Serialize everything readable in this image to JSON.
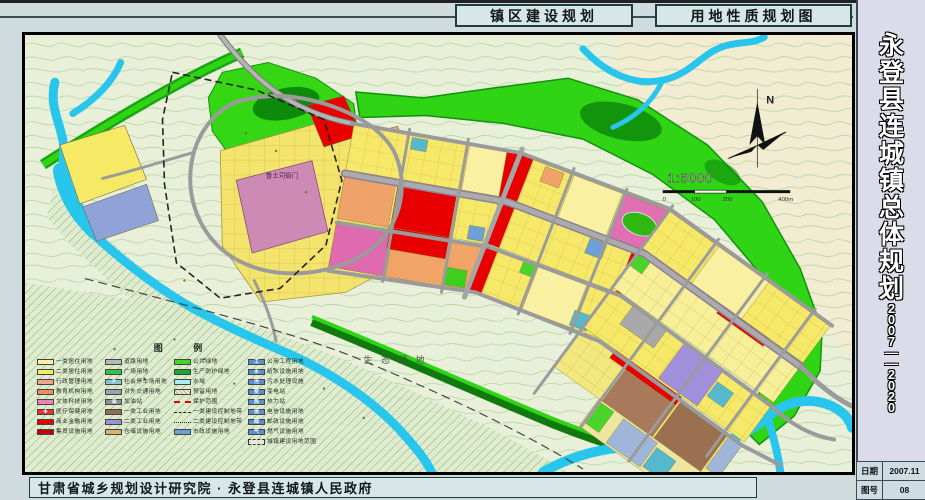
{
  "header": {
    "title_left": "镇区建设规划",
    "title_right": "用地性质规划图"
  },
  "sidebar": {
    "title": "永登县连城镇总体规划",
    "years": "2007——2020",
    "date_label": "日期",
    "date_value": "2007.11",
    "sheet_label": "图号",
    "sheet_value": "08"
  },
  "footer": {
    "credit": "甘肃省城乡规划设计研究院 · 永登县连城镇人民政府"
  },
  "map": {
    "north_label": "N",
    "scale": {
      "text": "1:5000",
      "ticks": [
        "0",
        "100",
        "200",
        "400m"
      ]
    },
    "labels": {
      "eco": "生 态 绿 地",
      "yamen": "鲁土司衙门"
    },
    "colors": {
      "residential1": "#f9f0a2",
      "residential2": "#f5e965",
      "commercial": "#e80000",
      "industry2": "#a090dc",
      "storage": "#a8795a",
      "green_public": "#2fd414",
      "water": "#28c6ec",
      "road": "#9b9b9b",
      "utility_blue": "#5b8fd0"
    },
    "legend": {
      "title": "图 例",
      "columns": [
        {
          "items": [
            {
              "label": "一类居住用地",
              "color": "#f9f0a2",
              "type": "fill"
            },
            {
              "label": "二类居住用地",
              "color": "#f5e965",
              "type": "fill"
            },
            {
              "label": "行政管理用地",
              "color": "#f2a687",
              "type": "fill"
            },
            {
              "label": "教育机构用地",
              "color": "#ef8e5a",
              "type": "fill"
            },
            {
              "label": "文体科技用地",
              "color": "#ee84b4",
              "type": "fill"
            },
            {
              "label": "医疗保健用地",
              "color": "#e83030",
              "type": "fill",
              "icon": "✚"
            },
            {
              "label": "商业金融用地",
              "color": "#e60000",
              "type": "fill"
            },
            {
              "label": "集贸设施用地",
              "color": "#c40000",
              "type": "fill"
            }
          ]
        },
        {
          "items": [
            {
              "label": "道路用地",
              "color": "#b8b8b8",
              "type": "fill"
            },
            {
              "label": "广场用地",
              "color": "#35c24a",
              "type": "fill"
            },
            {
              "label": "社会停车场用地",
              "color": "#8fc3d4",
              "type": "fill",
              "icon": "P"
            },
            {
              "label": "对外交通用地",
              "color": "#9aa4ac",
              "type": "fill"
            },
            {
              "label": "加油站",
              "color": "#8c9298",
              "type": "fill",
              "icon": "油"
            },
            {
              "label": "一类工业用地",
              "color": "#8d6e4f",
              "type": "fill"
            },
            {
              "label": "二类工业用地",
              "color": "#a090dc",
              "type": "fill"
            },
            {
              "label": "仓储设施用地",
              "color": "#d9b36e",
              "type": "fill"
            }
          ]
        },
        {
          "items": [
            {
              "label": "公共绿地",
              "color": "#3ddb20",
              "type": "fill"
            },
            {
              "label": "生产防护绿地",
              "color": "#18a832",
              "type": "fill"
            },
            {
              "label": "水域",
              "color": "#a8ecf6",
              "type": "fill"
            },
            {
              "label": "预留用地",
              "color": "#f0ead0",
              "type": "hatch"
            },
            {
              "label": "保护范围",
              "color": "#e10000",
              "type": "dash-red"
            },
            {
              "label": "一类建设控制地带",
              "color": "#222222",
              "type": "dashdot"
            },
            {
              "label": "二类建设控制地带",
              "color": "#222222",
              "type": "dash"
            },
            {
              "label": "市政设施用地",
              "color": "#6f9fd8",
              "type": "fill"
            }
          ]
        },
        {
          "items": [
            {
              "label": "公用工程用地",
              "color": "#5b8fd0",
              "type": "fill",
              "icon": "工"
            },
            {
              "label": "给水设施用地",
              "color": "#5b8fd0",
              "type": "fill",
              "icon": "水"
            },
            {
              "label": "污水处理设施",
              "color": "#5b8fd0",
              "type": "fill",
              "icon": "污"
            },
            {
              "label": "变电站",
              "color": "#5b8fd0",
              "type": "fill",
              "icon": "变"
            },
            {
              "label": "热力站",
              "color": "#5b8fd0",
              "type": "fill",
              "icon": "热"
            },
            {
              "label": "电信设施用地",
              "color": "#5b8fd0",
              "type": "fill",
              "icon": "信"
            },
            {
              "label": "邮政设施用地",
              "color": "#5b8fd0",
              "type": "fill",
              "icon": "邮"
            },
            {
              "label": "燃气设施用地",
              "color": "#5b8fd0",
              "type": "fill",
              "icon": "气"
            },
            {
              "label": "城镇建设用地范围",
              "color": "#333333",
              "type": "dash-box"
            }
          ]
        }
      ]
    }
  }
}
